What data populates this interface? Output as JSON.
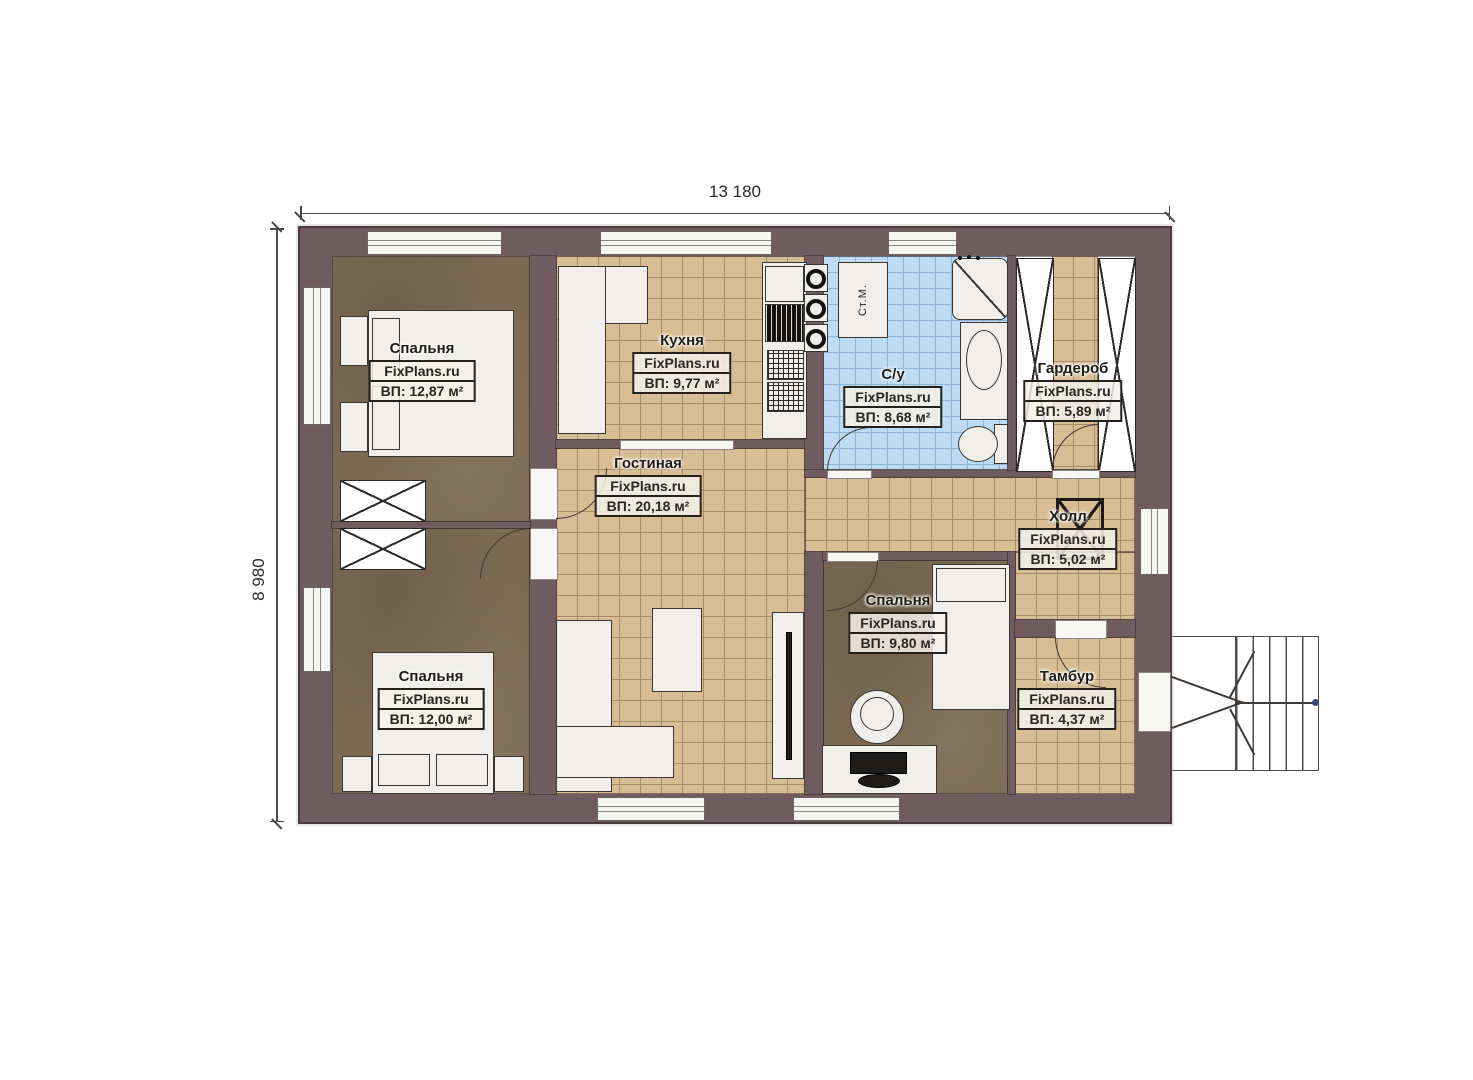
{
  "dimensions": {
    "width": "13 180",
    "height": "8 980"
  },
  "brand": "FixPlans.ru",
  "labels": {
    "washing_machine": "Ст.М."
  },
  "rooms": [
    {
      "key": "bedroom-top-left",
      "name": "Спальня",
      "watermark": "FixPlans.ru",
      "area": "ВП: 12,87 м²"
    },
    {
      "key": "kitchen",
      "name": "Кухня",
      "watermark": "FixPlans.ru",
      "area": "ВП: 9,77 м²"
    },
    {
      "key": "bathroom",
      "name": "С/у",
      "watermark": "FixPlans.ru",
      "area": "ВП: 8,68 м²"
    },
    {
      "key": "wardrobe",
      "name": "Гардероб",
      "watermark": "FixPlans.ru",
      "area": "ВП: 5,89 м²"
    },
    {
      "key": "living-room",
      "name": "Гостиная",
      "watermark": "FixPlans.ru",
      "area": "ВП: 20,18 м²"
    },
    {
      "key": "hall",
      "name": "Холл",
      "watermark": "FixPlans.ru",
      "area": "ВП: 5,02 м²"
    },
    {
      "key": "bedroom-bottom-center",
      "name": "Спальня",
      "watermark": "FixPlans.ru",
      "area": "ВП: 9,80 м²"
    },
    {
      "key": "bedroom-bottom-left",
      "name": "Спальня",
      "watermark": "FixPlans.ru",
      "area": "ВП: 12,00 м²"
    },
    {
      "key": "tambour",
      "name": "Тамбур",
      "watermark": "FixPlans.ru",
      "area": "ВП: 4,37 м²"
    }
  ],
  "colors": {
    "wall": "#6f5b60",
    "wood_floor": "#7c6a53",
    "tile": "#d7bd94",
    "bath_tile": "#bedbf4"
  }
}
